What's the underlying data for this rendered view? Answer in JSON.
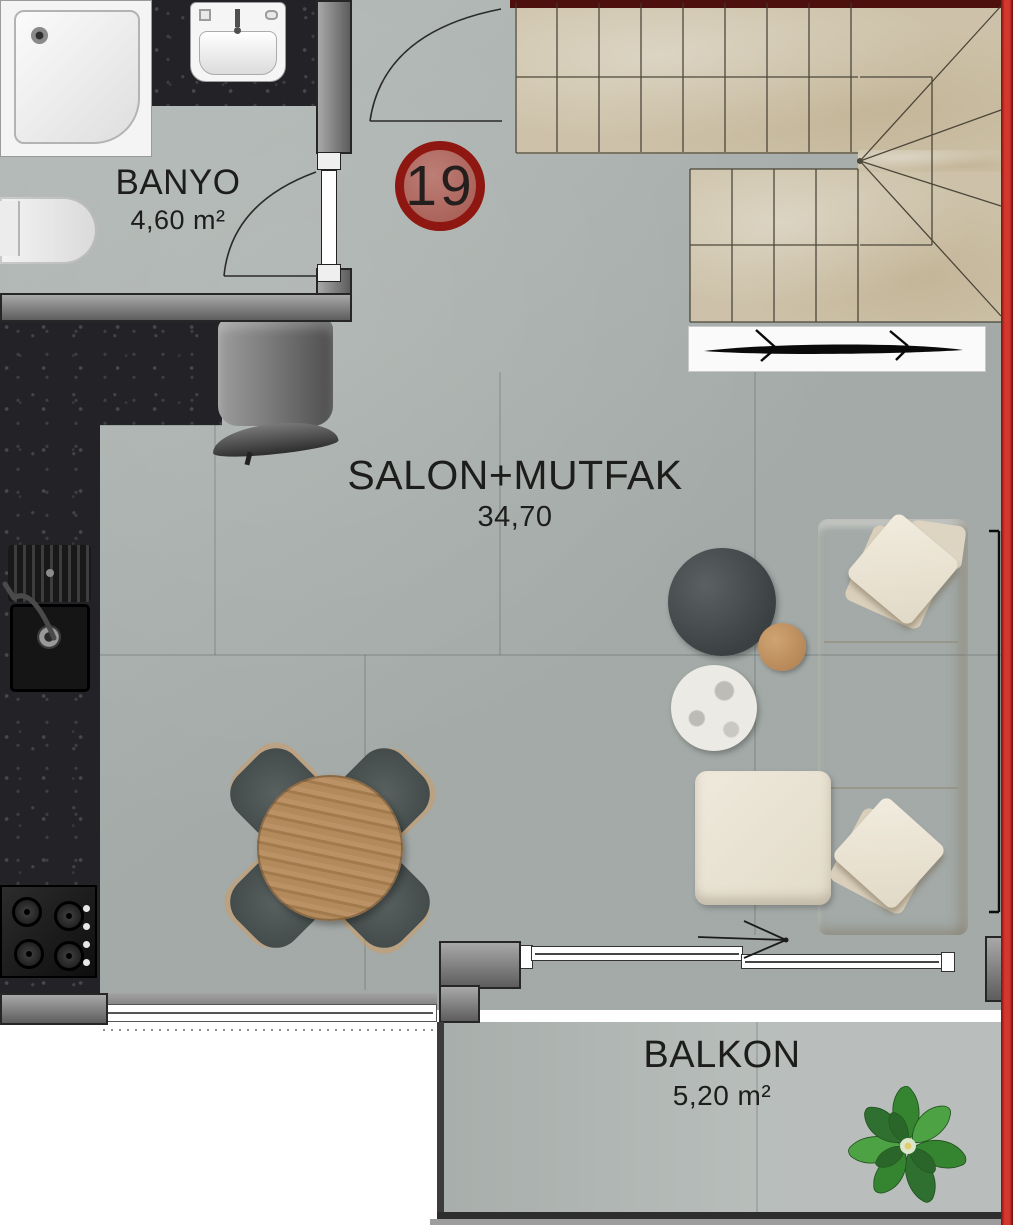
{
  "unit": {
    "number": "19"
  },
  "rooms": [
    {
      "name": "BANYO",
      "area": "4,60 m²"
    },
    {
      "name": "SALON+MUTFAK",
      "area": "34,70"
    },
    {
      "name": "BALKON",
      "area": "5,20 m²"
    }
  ],
  "colors": {
    "accent_red_strip": "#d4372e",
    "badge_ring": "#8e1711",
    "badge_fill": "#a55a51",
    "floor_gray": "#adb4b1",
    "stairs_beige": "#cdc2a9",
    "granite_black": "#232327",
    "wall_dark": "#262626",
    "sofa_cream": "#ece6d9",
    "table_wood": "#b08a5e",
    "plant_green": "#3d8c38"
  }
}
